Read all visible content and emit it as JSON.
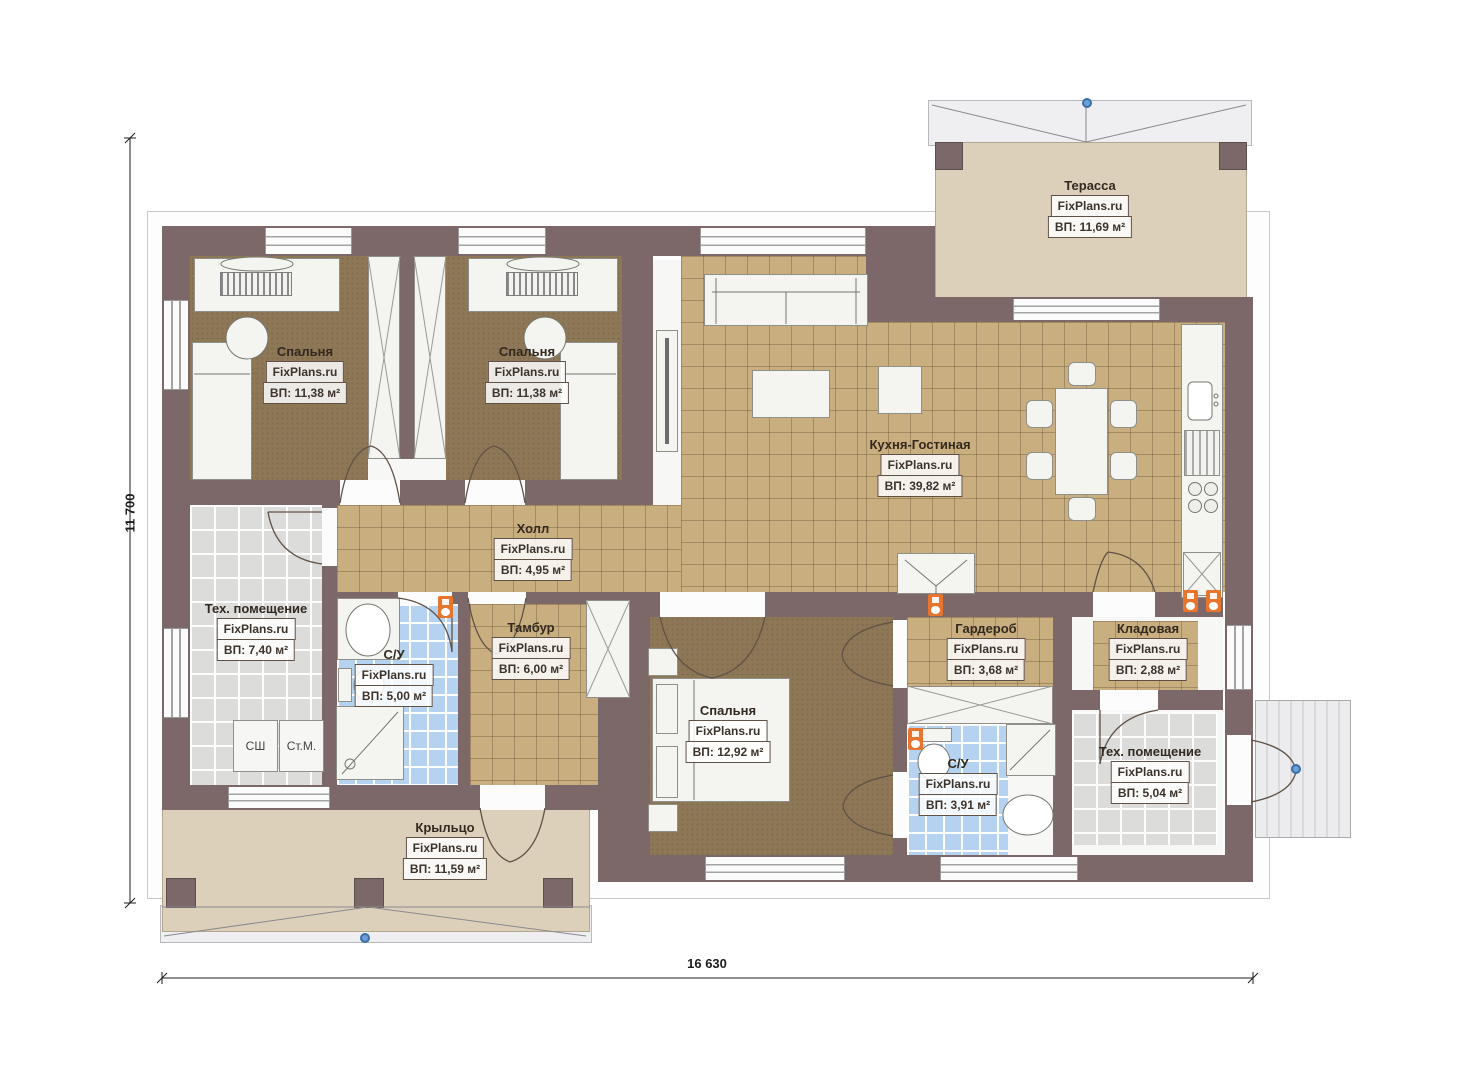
{
  "brand": "FixPlans.ru",
  "dimensions": {
    "width_label": "16 630",
    "height_label": "11 700"
  },
  "laundry": [
    "СШ",
    "Ст.М."
  ],
  "colors": {
    "wall": "#7c6868",
    "wood_floor": "#8d7756",
    "tile_tan": "#c9ae80",
    "tile_gray": "#dcdcda",
    "tile_blue": "#b5d3f0",
    "outdoor_slab": "#ddd0ba",
    "accent_orange": "#e8752e",
    "axis_marker_blue": "#6f9fd8"
  },
  "rooms": [
    {
      "name": "Терасса",
      "brand": "FixPlans.ru",
      "area": "ВП: 11,69 м²"
    },
    {
      "name": "Спальня",
      "brand": "FixPlans.ru",
      "area": "ВП: 11,38 м²"
    },
    {
      "name": "Спальня",
      "brand": "FixPlans.ru",
      "area": "ВП: 11,38 м²"
    },
    {
      "name": "Кухня-Гостиная",
      "brand": "FixPlans.ru",
      "area": "ВП: 39,82 м²"
    },
    {
      "name": "Холл",
      "brand": "FixPlans.ru",
      "area": "ВП: 4,95 м²"
    },
    {
      "name": "Тех. помещение",
      "brand": "FixPlans.ru",
      "area": "ВП: 7,40 м²"
    },
    {
      "name": "С/У",
      "brand": "FixPlans.ru",
      "area": "ВП: 5,00 м²"
    },
    {
      "name": "Тамбур",
      "brand": "FixPlans.ru",
      "area": "ВП: 6,00 м²"
    },
    {
      "name": "Спальня",
      "brand": "FixPlans.ru",
      "area": "ВП: 12,92 м²"
    },
    {
      "name": "Гардероб",
      "brand": "FixPlans.ru",
      "area": "ВП: 3,68 м²"
    },
    {
      "name": "Кладовая",
      "brand": "FixPlans.ru",
      "area": "ВП: 2,88 м²"
    },
    {
      "name": "С/У",
      "brand": "FixPlans.ru",
      "area": "ВП: 3,91 м²"
    },
    {
      "name": "Тех. помещение",
      "brand": "FixPlans.ru",
      "area": "ВП: 5,04 м²"
    },
    {
      "name": "Крыльцо",
      "brand": "FixPlans.ru",
      "area": "ВП: 11,59 м²"
    }
  ]
}
